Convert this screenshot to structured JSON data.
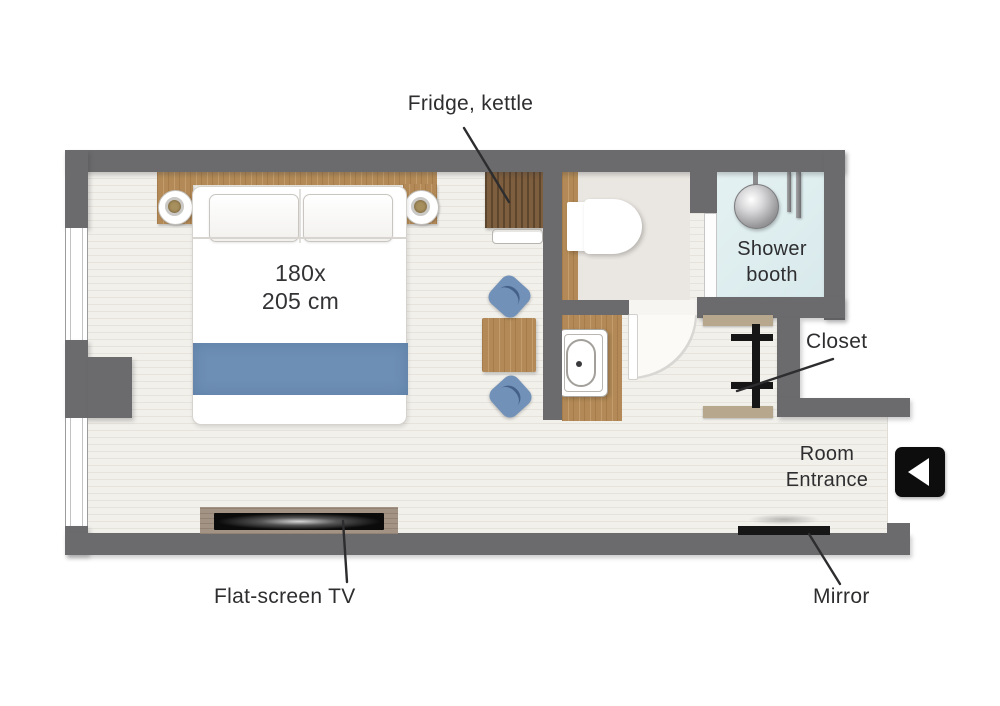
{
  "plan": {
    "type": "hotel-room-floor-plan",
    "bed": {
      "size_line1": "180x",
      "size_line2": "205 cm"
    },
    "labels": {
      "fridge_kettle": "Fridge, kettle",
      "shower_line1": "Shower",
      "shower_line2": "booth",
      "closet": "Closet",
      "entrance_line1": "Room",
      "entrance_line2": "Entrance",
      "mirror": "Mirror",
      "tv": "Flat-screen TV"
    },
    "icons": {
      "entrance_arrow": "left-triangle-in-black-square",
      "shower_head": "metal-circle",
      "closet_rail": "black-rod-with-hangers"
    },
    "colors": {
      "wall": "#6b6b6d",
      "floor": "#f1efe9",
      "bathroom_floor": "#eae6e1",
      "shower_floor": "#deedef",
      "wood": "#b38a57",
      "wood_dark": "#7d5e3e",
      "accent_blue": "#6d8eb5",
      "label_text": "#2e2e30"
    }
  }
}
